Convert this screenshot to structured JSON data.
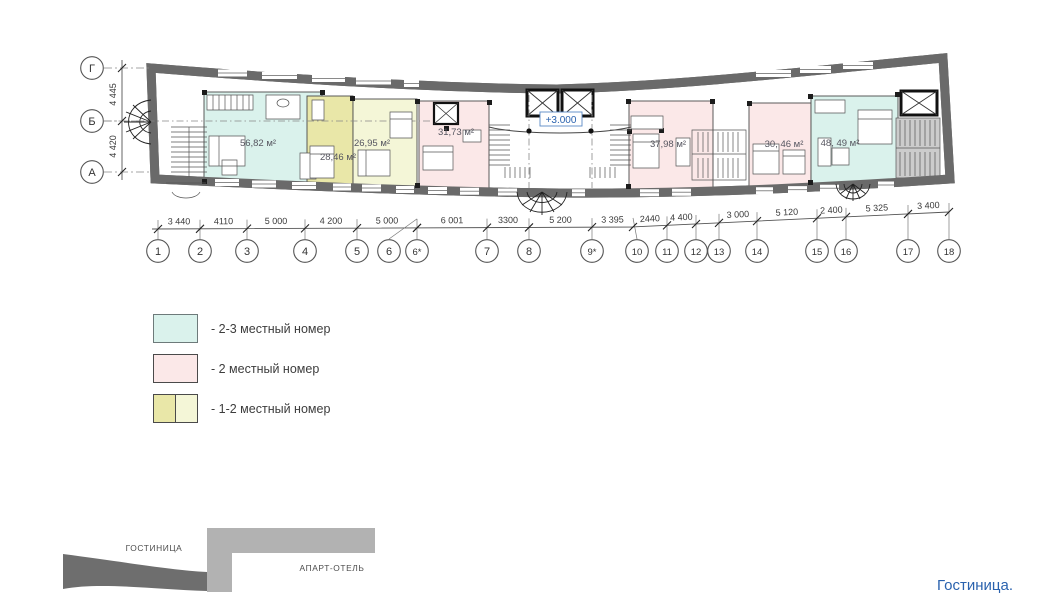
{
  "caption": "Гостиница.",
  "colors": {
    "teal": "#daf2ec",
    "pink": "#fbe8e8",
    "ydark": "#e9e7a8",
    "ylight": "#f4f6d7",
    "wall": "#6a6a6a",
    "blue": "#2a62ae",
    "site_dark": "#6e6e6e",
    "site_light": "#b2b2b2"
  },
  "legend": {
    "items": [
      {
        "label": "- 2-3 местный номер",
        "swatch": "teal"
      },
      {
        "label": "- 2 местный номер",
        "swatch": "pink"
      },
      {
        "label": "- 1-2 местный номер",
        "swatch": "yellow-split"
      }
    ]
  },
  "site_diagram": {
    "labels": [
      {
        "text": "ГОСТИНИЦА"
      },
      {
        "text": "АПАРТ-ОТЕЛЬ"
      }
    ]
  },
  "plan": {
    "level_mark": "+3.000",
    "row_axes": [
      {
        "label": "Г",
        "y": 68
      },
      {
        "label": "Б",
        "y": 121
      },
      {
        "label": "А",
        "y": 172
      }
    ],
    "vertical_dims": [
      {
        "label": "4 445",
        "y1": 68,
        "y2": 121
      },
      {
        "label": "4 420",
        "y1": 121,
        "y2": 172
      }
    ],
    "dim_line": {
      "points": [
        [
          152,
          229
        ],
        [
          632,
          227
        ],
        [
          949,
          212
        ]
      ]
    },
    "columns": [
      {
        "label": "1",
        "x": 158
      },
      {
        "label": "2",
        "x": 200
      },
      {
        "label": "3",
        "x": 247
      },
      {
        "label": "4",
        "x": 305
      },
      {
        "label": "5",
        "x": 357
      },
      {
        "label": "6",
        "x": 389,
        "tick": 417
      },
      {
        "label": "6*",
        "x": 417
      },
      {
        "label": "7",
        "x": 487
      },
      {
        "label": "8",
        "x": 529
      },
      {
        "label": "9*",
        "x": 592
      },
      {
        "label": "10",
        "x": 637,
        "tick": 633
      },
      {
        "label": "11",
        "x": 667
      },
      {
        "label": "12",
        "x": 696
      },
      {
        "label": "13",
        "x": 719
      },
      {
        "label": "14",
        "x": 757
      },
      {
        "label": "15",
        "x": 817
      },
      {
        "label": "16",
        "x": 846
      },
      {
        "label": "17",
        "x": 908
      },
      {
        "label": "18",
        "x": 949
      }
    ],
    "dims": [
      {
        "label": "3 440",
        "x1": 158,
        "x2": 200
      },
      {
        "label": "4110",
        "x1": 200,
        "x2": 247
      },
      {
        "label": "5 000",
        "x1": 247,
        "x2": 305
      },
      {
        "label": "4 200",
        "x1": 305,
        "x2": 357
      },
      {
        "label": "5 000",
        "x1": 357,
        "x2": 417
      },
      {
        "label": "6 001",
        "x1": 417,
        "x2": 487
      },
      {
        "label": "3300",
        "x1": 487,
        "x2": 529
      },
      {
        "label": "5 200",
        "x1": 529,
        "x2": 592
      },
      {
        "label": "3 395",
        "x1": 592,
        "x2": 633
      },
      {
        "label": "2440",
        "x1": 633,
        "x2": 667
      },
      {
        "label": "4 400",
        "x1": 667,
        "x2": 696
      },
      {
        "label": "3 000",
        "x1": 719,
        "x2": 757
      },
      {
        "label": "5 120",
        "x1": 757,
        "x2": 817
      },
      {
        "label": "2 400",
        "x1": 817,
        "x2": 846
      },
      {
        "label": "5 325",
        "x1": 846,
        "x2": 908
      },
      {
        "label": "3 400",
        "x1": 908,
        "x2": 949
      }
    ],
    "room_labels": [
      {
        "label": "56,82 м²",
        "x": 258,
        "y": 146
      },
      {
        "label": "28,46 м²",
        "x": 338,
        "y": 160
      },
      {
        "label": "26,95 м²",
        "x": 372,
        "y": 146
      },
      {
        "label": "31,73 м²",
        "x": 456,
        "y": 135
      },
      {
        "label": "37,98 м²",
        "x": 668,
        "y": 147
      },
      {
        "label": "30, 46 м²",
        "x": 784,
        "y": 147
      },
      {
        "label": "48, 49 м²",
        "x": 840,
        "y": 146
      }
    ]
  }
}
